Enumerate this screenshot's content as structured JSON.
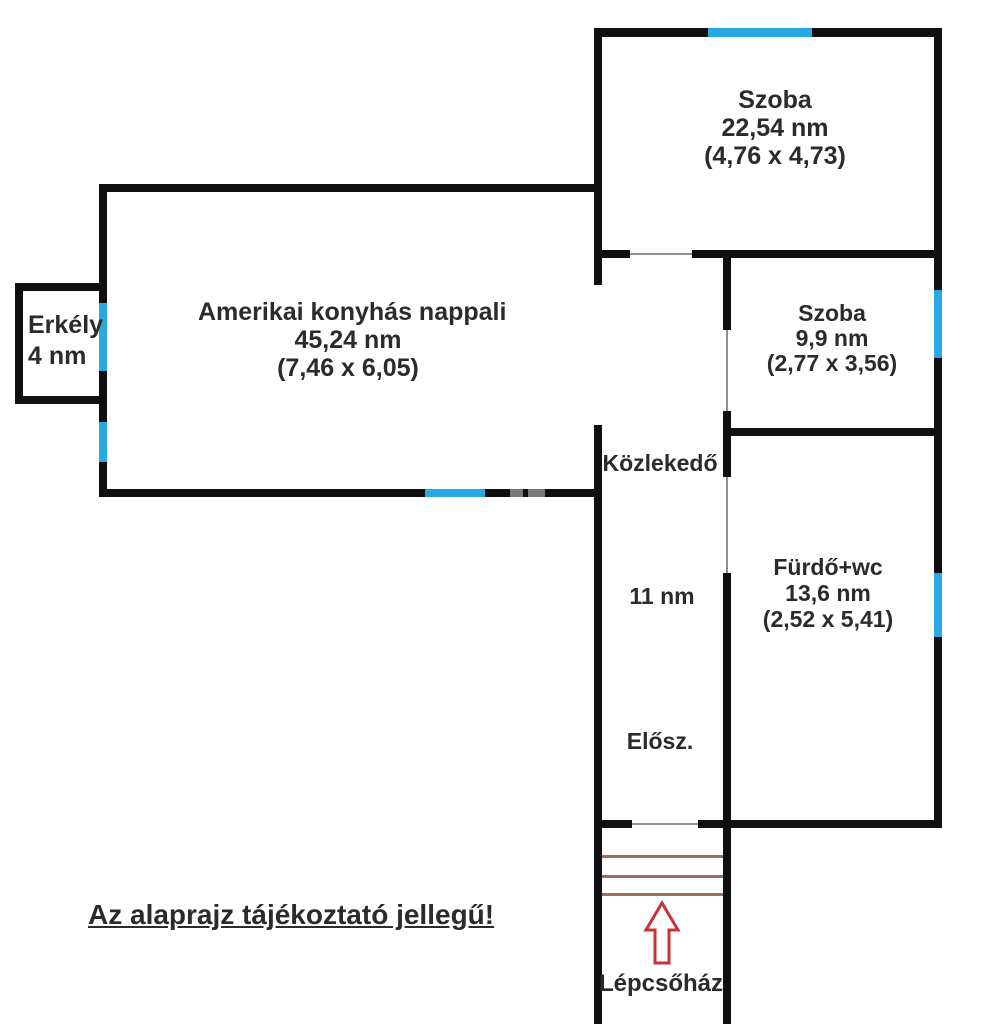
{
  "colors": {
    "wall": "#0f0f0f",
    "window": "#2aa9e0",
    "door_line": "#8f8f8f",
    "stair": "#9c7257",
    "arrow": "#c53336",
    "text": "#2b2b2b",
    "watermark": "#787878"
  },
  "rooms": {
    "szoba_large": {
      "name": "Szoba",
      "area": "22,54 nm",
      "dims": "(4,76 x 4,73)"
    },
    "szoba_small": {
      "name": "Szoba",
      "area": "9,9 nm",
      "dims": "(2,77 x 3,56)"
    },
    "nappali": {
      "name": "Amerikai konyhás nappali",
      "area": "45,24 nm",
      "dims": "(7,46 x 6,05)"
    },
    "erkely": {
      "name": "Erkély",
      "area": "4 nm"
    },
    "kozlekedo": {
      "name": "Közlekedő",
      "area": "11 nm"
    },
    "eloszoba": {
      "name": "Elősz."
    },
    "furdo": {
      "name": "Fürdő+wc",
      "area": "13,6 nm",
      "dims": "(2,52 x 5,41)"
    },
    "lepcsohaz": {
      "name": "Lépcsőház"
    }
  },
  "disclaimer": "Az alaprajz tájékoztató jellegű!"
}
